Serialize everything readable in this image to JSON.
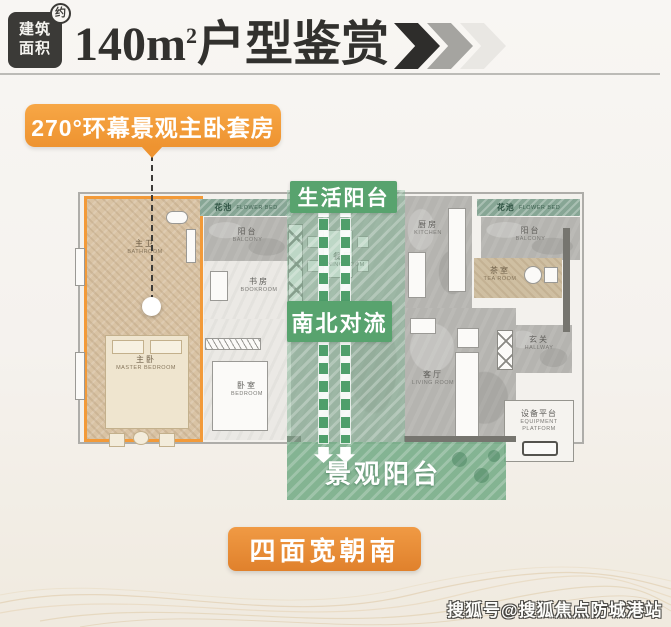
{
  "colors": {
    "accent_orange": "#f29a39",
    "deep_orange": "#e0812c",
    "green": "#58a36e",
    "badge_dark": "#3b3a37",
    "flowerbed_green": "#87a695",
    "master_tan": "#d9c3a4"
  },
  "header": {
    "badge_line1": "建筑",
    "badge_line2": "面积",
    "badge_sup": "约",
    "title_num": "140m",
    "title_sup": "2",
    "title_text": "户型鉴赏"
  },
  "callout": {
    "label": "270°环幕景观主卧套房"
  },
  "plan": {
    "master": {
      "bath_cn": "主卫",
      "bath_en": "BATHROOM",
      "cn": "主卧",
      "en": "MASTER BEDROOM"
    },
    "rooms": {
      "flowerbed_left": {
        "cn": "花池",
        "en": "FLOWER BED"
      },
      "balcony_left": {
        "cn": "阳台",
        "en": "BALCONY"
      },
      "bookroom": {
        "cn": "书房",
        "en": "BOOKROOM"
      },
      "bedroom": {
        "cn": "卧室",
        "en": "BEDROOM"
      },
      "dining": {
        "cn": "餐厅",
        "en": "DINING ROOM"
      },
      "kitchen": {
        "cn": "厨房",
        "en": "KITCHEN"
      },
      "flowerbed_right": {
        "cn": "花池",
        "en": "FLOWER BED"
      },
      "balcony_right": {
        "cn": "阳台",
        "en": "BALCONY"
      },
      "tearoom": {
        "cn": "茶室",
        "en": "TEA ROOM"
      },
      "hallway": {
        "cn": "玄关",
        "en": "HALLWAY"
      },
      "bathroom": {
        "cn": "公卫",
        "en": "BATHROOM"
      },
      "living": {
        "cn": "客厅",
        "en": "LIVING ROOM"
      },
      "equipment": {
        "cn": "设备平台",
        "en": "EQUIPMENT PLATFORM"
      }
    },
    "annotations": {
      "top_balcony": "生活阳台",
      "airflow": "南北对流",
      "view_balcony": "景观阳台"
    }
  },
  "footer": {
    "button": "四面宽朝南"
  },
  "watermark": "搜狐号@搜狐焦点防城港站"
}
